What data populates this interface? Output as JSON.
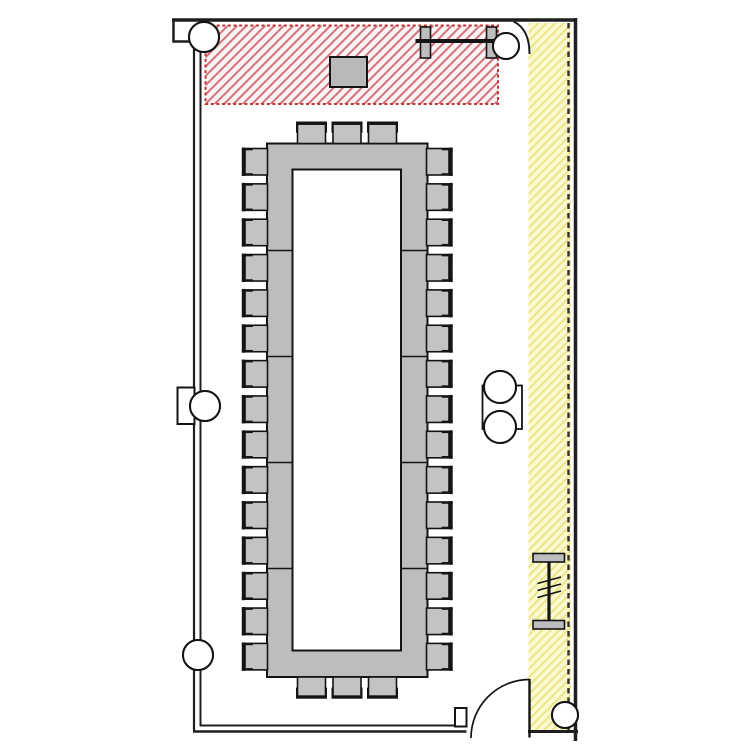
{
  "document": {
    "type": "architectural-floor-plan",
    "subject": "Conference room layout plan with hollow rectangular boardroom table, stage zone and side corridor"
  },
  "colors": {
    "wall": "#1f1f1f",
    "line": "#141414",
    "table_fill": "#bdbdbd",
    "chair_fill": "#c3c3c3",
    "podium_fill": "#b9b9b9",
    "red_zone_border": "#c23535",
    "red_zone_line": "#d4717b",
    "red_zone_bg": "#fbf4f4",
    "yellow_zone_bg": "#fbf9cf",
    "yellow_zone_line": "#ebe382",
    "dash_line": "#30302a"
  },
  "zones": [
    {
      "name": "stage-zone",
      "hatch": "red-diagonal"
    },
    {
      "name": "corridor-zone",
      "hatch": "yellow-diagonal"
    }
  ],
  "table": {
    "shape": "hollow-rectangle",
    "seats": {
      "left": 15,
      "right": 15,
      "top": 3,
      "bottom": 3
    },
    "total_seats": 36
  },
  "symbols": {
    "column_marker_count": 7,
    "beam_symbol_count": 2,
    "door_count": 1,
    "podium_count": 1
  }
}
